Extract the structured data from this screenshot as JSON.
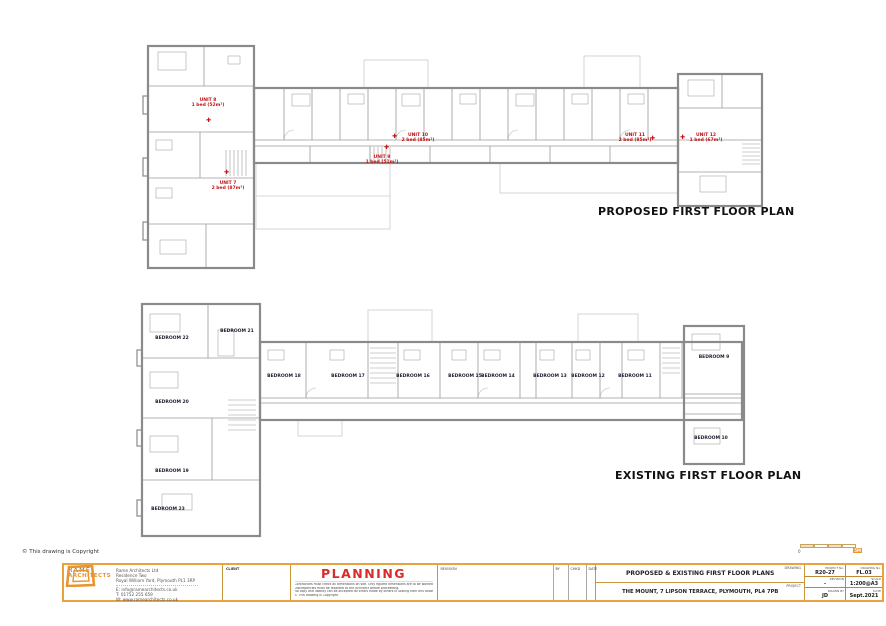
{
  "page": {
    "copyright": "© This drawing is Copyright"
  },
  "colors": {
    "accent_orange": "#E8952F",
    "status_red": "#D92B2B",
    "unit_red": "#C11212"
  },
  "icons": {
    "entry_marker": "✚"
  },
  "proposed": {
    "title": "PROPOSED FIRST FLOOR PLAN",
    "units": [
      {
        "name": "UNIT 8",
        "desc": "1 bed (52m²)"
      },
      {
        "name": "UNIT 7",
        "desc": "2 bed (87m²)"
      },
      {
        "name": "UNIT 9",
        "desc": "1 bed (51m²)"
      },
      {
        "name": "UNIT 10",
        "desc": "2 bed (85m²)"
      },
      {
        "name": "UNIT 11",
        "desc": "2 bed (85m²)"
      },
      {
        "name": "UNIT 12",
        "desc": "1 bed (67m²)"
      }
    ]
  },
  "existing": {
    "title": "EXISTING FIRST FLOOR PLAN",
    "bedrooms": [
      "BEDROOM 22",
      "BEDROOM 21",
      "BEDROOM 20",
      "BEDROOM 19",
      "BEDROOM 23",
      "BEDROOM 18",
      "BEDROOM 17",
      "BEDROOM 16",
      "BEDROOM 15",
      "BEDROOM 14",
      "BEDROOM 13",
      "BEDROOM 12",
      "BEDROOM 11",
      "BEDROOM 9",
      "BEDROOM 10"
    ]
  },
  "scalebar": {
    "zero": "0",
    "end": "5M"
  },
  "titleblock": {
    "firm": {
      "wordmark_top": "RAME",
      "wordmark_bottom": "ARCHITECTS",
      "company": "Rame Architects Ltd",
      "address1": "Residence Two",
      "address2": "Royal William Yard, Plymouth PL1 3RP",
      "email": "E: info@ramearchitects.co.uk",
      "phone": "T: 01752 255 659",
      "web": "W: www.ramearchitects.co.uk"
    },
    "client_label": "CLIENT",
    "status": {
      "label": "PLANNING",
      "note1": "Contractors must check all dimensions on site.  Only figured dimensions are to be worked from.",
      "note2": "Discrepancies must be reported to the Architect before proceeding.",
      "note3": "No copy and liability can be accepted for errors made by others in scaling from this drawing.",
      "note4": "© This drawing is Copyright"
    },
    "revision_table": {
      "revision": "REVISION",
      "by": "BY",
      "chkd": "CHKD",
      "date": "DATE"
    },
    "drawing": {
      "label": "DRAWING",
      "value": "PROPOSED & EXISTING FIRST FLOOR PLANS"
    },
    "project": {
      "label": "PROJECT",
      "value": "THE MOUNT, 7 LIPSON TERRACE, PLYMOUTH, PL4 7PB"
    },
    "meta": {
      "project_no_label": "PROJECT No.",
      "project_no": "R20-27",
      "drawing_no_label": "DRAWING No.",
      "drawing_no": "FL.03",
      "revision_label": "REVISION",
      "revision": "-",
      "scale_label": "SCALE",
      "scale": "1:200@A3",
      "drawn_by_label": "DRAWN BY",
      "drawn_by": "JD",
      "date_label": "DATE",
      "date": "Sept.2021"
    }
  }
}
